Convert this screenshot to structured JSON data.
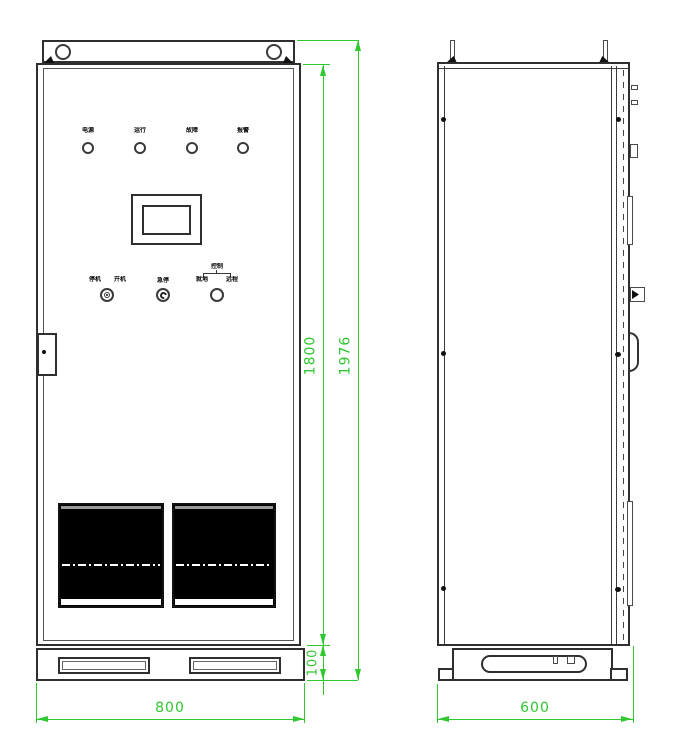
{
  "front_panel": {
    "indicators": [
      {
        "label": "电源"
      },
      {
        "label": "运行"
      },
      {
        "label": "故障"
      },
      {
        "label": "报警"
      }
    ],
    "controls": {
      "selector_label_left": "停机",
      "selector_label_right": "开机",
      "emergency_label": "急停",
      "mode_title": "控制",
      "mode_option_left": "就地",
      "mode_option_right": "远程"
    }
  },
  "dimensions": {
    "front_width": "800",
    "depth": "600",
    "door_height": "1800",
    "overall_height": "1976",
    "base_height": "100"
  },
  "colors": {
    "dimension_green": "#2fc82f",
    "line_dark": "#2f2f2f",
    "vent_fill": "#000000"
  }
}
